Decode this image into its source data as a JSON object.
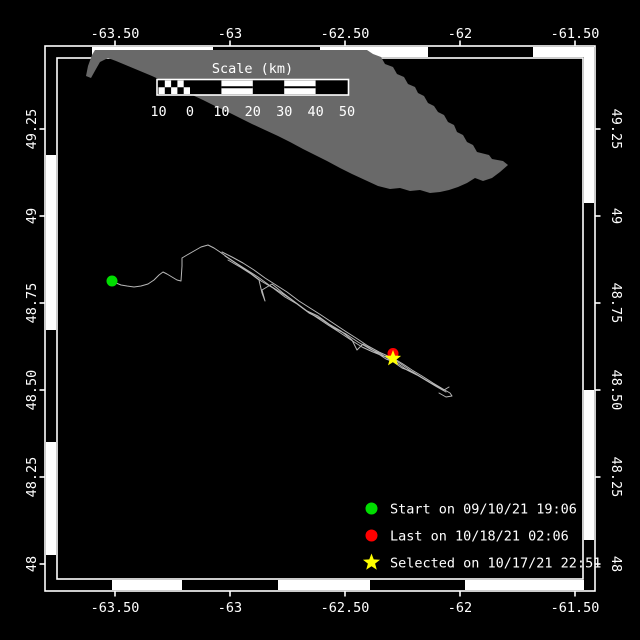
{
  "window": {
    "title": "Track map"
  },
  "colors": {
    "background": "#000000",
    "island": "#696969",
    "track": "#b8b8b8",
    "frame": "#ffffff",
    "text": "#ffffff",
    "start": "#00dd00",
    "last": "#ff0000",
    "selected": "#ffff00"
  },
  "axes": {
    "top_labels": [
      "-63.50",
      "-63",
      "-62.50",
      "-62",
      "-61.50"
    ],
    "bottom_labels": [
      "-63.50",
      "-63",
      "-62.50",
      "-62",
      "-61.50"
    ],
    "left_labels": [
      "49.25",
      "49",
      "48.75",
      "48.50",
      "48.25",
      "48"
    ],
    "right_labels": [
      "49.25",
      "49",
      "48.75",
      "48.50",
      "48.25",
      "48"
    ],
    "lon_tick_x": [
      115,
      230,
      345,
      460,
      575
    ],
    "lat_tick_y": [
      129,
      216,
      303,
      390,
      477,
      564
    ]
  },
  "frame": {
    "outer": [
      45,
      46,
      595,
      591
    ],
    "inner": [
      57,
      58,
      583,
      579
    ],
    "zebra_white": {
      "top": [
        [
          92,
          213
        ],
        [
          320,
          428
        ],
        [
          533,
          594
        ]
      ],
      "bottom": [
        [
          112,
          182
        ],
        [
          278,
          370
        ],
        [
          465,
          584
        ]
      ],
      "left": [
        [
          155,
          330
        ],
        [
          442,
          555
        ]
      ],
      "right": [
        [
          47,
          203
        ],
        [
          390,
          540
        ]
      ]
    }
  },
  "scale_bar": {
    "title": "Scale (km)",
    "labels": [
      "10",
      "0",
      "10",
      "20",
      "30",
      "40",
      "50"
    ],
    "boundaries_x": [
      158.5,
      190,
      221.4,
      252.8,
      284.2,
      315.6,
      347
    ],
    "bar_y": 80.5,
    "bar_height": 13.5,
    "labels_y": 116,
    "title_x": 252.5,
    "title_y": 73
  },
  "legend": {
    "entries": [
      {
        "marker": "circle",
        "color": "#00dd00",
        "label": "Start on 09/10/21 19:06"
      },
      {
        "marker": "circle",
        "color": "#ff0000",
        "label": "Last on 10/18/21 02:06"
      },
      {
        "marker": "star",
        "color": "#ffff00",
        "label": "Selected on 10/17/21 22:51"
      }
    ]
  },
  "track": {
    "start_point": [
      112,
      281
    ],
    "last_point": [
      393,
      353.5
    ],
    "selected_point": [
      393,
      358.5
    ],
    "lines": [
      [
        [
          112,
          281
        ],
        [
          116,
          283
        ],
        [
          121,
          285
        ],
        [
          127,
          286
        ],
        [
          134,
          287
        ],
        [
          141,
          286
        ],
        [
          148,
          284
        ],
        [
          154,
          280
        ],
        [
          159,
          275
        ],
        [
          163,
          272
        ],
        [
          167,
          274
        ],
        [
          172,
          277
        ],
        [
          177,
          280
        ],
        [
          181,
          281
        ],
        [
          182,
          266
        ],
        [
          182,
          258
        ],
        [
          187,
          255
        ],
        [
          194,
          251
        ],
        [
          201,
          247
        ],
        [
          208,
          245
        ],
        [
          214,
          248
        ],
        [
          220,
          252
        ],
        [
          227,
          257
        ],
        [
          236,
          263
        ],
        [
          247,
          270
        ],
        [
          258,
          277
        ],
        [
          269,
          285
        ],
        [
          280,
          292
        ],
        [
          292,
          300
        ],
        [
          304,
          309
        ],
        [
          316,
          317
        ],
        [
          328,
          325
        ],
        [
          339,
          332
        ],
        [
          351,
          340
        ],
        [
          362,
          347
        ],
        [
          373,
          352
        ],
        [
          383,
          356
        ],
        [
          393,
          358
        ],
        [
          403,
          364
        ],
        [
          412,
          370
        ],
        [
          422,
          376
        ],
        [
          433,
          383
        ],
        [
          443,
          389
        ],
        [
          450,
          393
        ],
        [
          452,
          396
        ],
        [
          446,
          397
        ],
        [
          439,
          393
        ]
      ],
      [
        [
          222,
          252
        ],
        [
          232,
          257
        ],
        [
          243,
          263
        ],
        [
          254,
          270
        ],
        [
          265,
          278
        ],
        [
          276,
          285
        ],
        [
          287,
          292
        ],
        [
          299,
          301
        ],
        [
          310,
          308
        ],
        [
          321,
          315
        ],
        [
          333,
          323
        ],
        [
          345,
          331
        ],
        [
          356,
          338
        ],
        [
          368,
          346
        ],
        [
          379,
          352
        ],
        [
          390,
          357
        ],
        [
          401,
          364
        ],
        [
          411,
          371
        ],
        [
          421,
          377
        ],
        [
          431,
          383
        ],
        [
          441,
          388
        ]
      ],
      [
        [
          228,
          260
        ],
        [
          240,
          267
        ],
        [
          251,
          274
        ],
        [
          259,
          280
        ],
        [
          262,
          293
        ],
        [
          265,
          301
        ],
        [
          262,
          290
        ],
        [
          272,
          284
        ],
        [
          283,
          293
        ],
        [
          295,
          302
        ],
        [
          307,
          311
        ],
        [
          318,
          316
        ],
        [
          329,
          324
        ],
        [
          341,
          331
        ],
        [
          352,
          340
        ],
        [
          357,
          350
        ],
        [
          363,
          344
        ],
        [
          374,
          351
        ],
        [
          386,
          359
        ],
        [
          397,
          363
        ],
        [
          407,
          370
        ],
        [
          417,
          375
        ],
        [
          427,
          381
        ],
        [
          437,
          387
        ],
        [
          446,
          392
        ]
      ],
      [
        [
          225,
          256
        ],
        [
          237,
          264
        ],
        [
          249,
          272
        ],
        [
          261,
          281
        ],
        [
          273,
          288
        ],
        [
          285,
          297
        ],
        [
          297,
          304
        ],
        [
          309,
          313
        ],
        [
          321,
          319
        ],
        [
          334,
          328
        ],
        [
          346,
          334
        ],
        [
          358,
          342
        ],
        [
          370,
          349
        ],
        [
          381,
          354
        ],
        [
          392,
          361
        ],
        [
          402,
          368
        ],
        [
          413,
          372
        ],
        [
          424,
          379
        ],
        [
          434,
          385
        ],
        [
          444,
          390
        ],
        [
          449,
          387
        ]
      ]
    ]
  },
  "island": {
    "points": [
      [
        95,
        50
      ],
      [
        367,
        50
      ],
      [
        373,
        54
      ],
      [
        381,
        57
      ],
      [
        385,
        64
      ],
      [
        393,
        67
      ],
      [
        397,
        74
      ],
      [
        404,
        77
      ],
      [
        408,
        84
      ],
      [
        415,
        87
      ],
      [
        418,
        93
      ],
      [
        424,
        96
      ],
      [
        428,
        103
      ],
      [
        434,
        106
      ],
      [
        438,
        112
      ],
      [
        444,
        115
      ],
      [
        448,
        122
      ],
      [
        454,
        125
      ],
      [
        457,
        132
      ],
      [
        463,
        135
      ],
      [
        467,
        142
      ],
      [
        473,
        145
      ],
      [
        477,
        152
      ],
      [
        489,
        155
      ],
      [
        492,
        159
      ],
      [
        503,
        161
      ],
      [
        508,
        165
      ],
      [
        500,
        172
      ],
      [
        492,
        178
      ],
      [
        483,
        181
      ],
      [
        475,
        178
      ],
      [
        467,
        183
      ],
      [
        458,
        187
      ],
      [
        449,
        190
      ],
      [
        440,
        192
      ],
      [
        430,
        193
      ],
      [
        420,
        190
      ],
      [
        410,
        191
      ],
      [
        400,
        188
      ],
      [
        390,
        189
      ],
      [
        378,
        186
      ],
      [
        365,
        180
      ],
      [
        352,
        174
      ],
      [
        340,
        168
      ],
      [
        327,
        161
      ],
      [
        315,
        155
      ],
      [
        303,
        149
      ],
      [
        290,
        142
      ],
      [
        278,
        136
      ],
      [
        265,
        130
      ],
      [
        252,
        124
      ],
      [
        240,
        118
      ],
      [
        228,
        112
      ],
      [
        215,
        106
      ],
      [
        203,
        100
      ],
      [
        190,
        94
      ],
      [
        178,
        88
      ],
      [
        165,
        82
      ],
      [
        152,
        76
      ],
      [
        140,
        71
      ],
      [
        128,
        66
      ],
      [
        116,
        61
      ],
      [
        108,
        58
      ],
      [
        100,
        62
      ],
      [
        96,
        69
      ],
      [
        91,
        78
      ],
      [
        86,
        76
      ],
      [
        88,
        66
      ],
      [
        92,
        55
      ]
    ]
  }
}
